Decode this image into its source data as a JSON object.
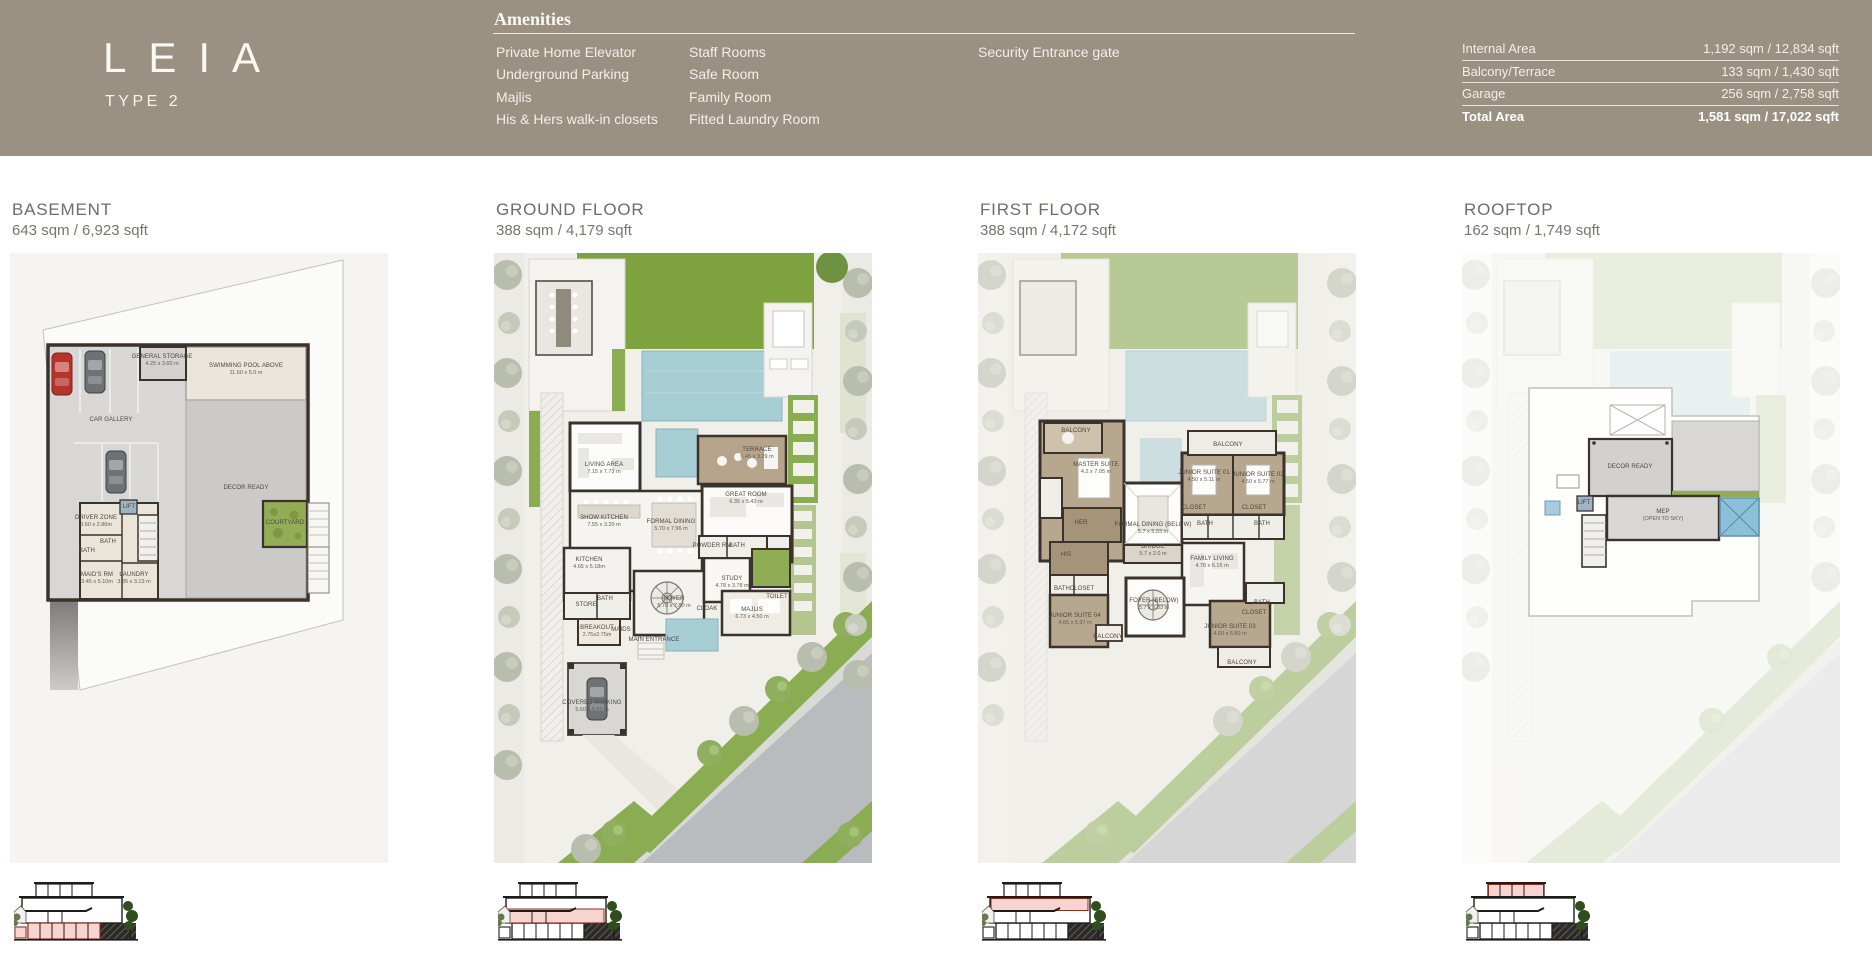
{
  "brand": {
    "logo": "LEIA",
    "subtitle": "TYPE 2"
  },
  "amenities": {
    "title": "Amenities",
    "columns": [
      [
        "Private Home Elevator",
        "Underground Parking",
        "Majlis",
        "His & Hers walk-in closets"
      ],
      [
        "Staff Rooms",
        "Safe Room",
        "Family Room",
        "Fitted Laundry Room"
      ],
      [
        "Security Entrance gate"
      ]
    ]
  },
  "areas": {
    "rows": [
      {
        "label": "Internal Area",
        "value": "1,192 sqm / 12,834 sqft",
        "bold": false
      },
      {
        "label": "Balcony/Terrace",
        "value": "133 sqm / 1,430 sqft",
        "bold": false
      },
      {
        "label": "Garage",
        "value": "256 sqm / 2,758 sqft",
        "bold": false
      },
      {
        "label": "Total Area",
        "value": "1,581 sqm / 17,022 sqft",
        "bold": true
      }
    ]
  },
  "colors": {
    "header_bg": "#9a9183",
    "header_text": "#f6f3eb",
    "floor_title": "#6e6d66",
    "highlight_pink": "#f6c9c6",
    "pool_blue": "#a7cdd5",
    "lawn_green": "#7da23e",
    "wall_dark": "#3a322b",
    "courtyard_green": "#8fad55",
    "road_gray": "#b9bcbf"
  },
  "floors": [
    {
      "id": "basement",
      "title": "BASEMENT",
      "area": "643 sqm / 6,923 sqft",
      "highlight": "basement",
      "rooms": [
        {
          "t": "GENERAL STORAGE",
          "s": "4.25 x 3.60 m",
          "x": 152,
          "y": 107
        },
        {
          "t": "SWIMMING POOL ABOVE",
          "s": "11.60 x 5.0 m",
          "x": 236,
          "y": 116
        },
        {
          "t": "CAR GALLERY",
          "x": 101,
          "y": 167
        },
        {
          "t": "DECOR READY",
          "x": 236,
          "y": 235
        },
        {
          "t": "LIFT",
          "x": 119,
          "y": 254
        },
        {
          "t": "DRIVER ZONE",
          "s": "3.60 x 2.86m",
          "x": 86,
          "y": 268
        },
        {
          "t": "BATH",
          "x": 98,
          "y": 289
        },
        {
          "t": "BATH",
          "x": 77,
          "y": 298
        },
        {
          "t": "MAID'S RM",
          "s": "3.45 x 5.10m",
          "x": 87,
          "y": 325
        },
        {
          "t": "LAUNDRY",
          "s": "3.85 x 3.13 m",
          "x": 124,
          "y": 325
        },
        {
          "t": "COURTYARD",
          "x": 275,
          "y": 270
        }
      ]
    },
    {
      "id": "ground",
      "title": "GROUND FLOOR",
      "area": "388 sqm / 4,179 sqft",
      "highlight": "ground",
      "rooms": [
        {
          "t": "LIVING AREA",
          "s": "7.15 x 7.73 m",
          "x": 110,
          "y": 215
        },
        {
          "t": "TERRACE",
          "s": "6.45 x 3.29 m",
          "x": 263,
          "y": 200
        },
        {
          "t": "GREAT ROOM",
          "s": "6.35 x 5.43 m",
          "x": 252,
          "y": 245
        },
        {
          "t": "SHOW KITCHEN",
          "s": "7.55 x 3.20 m",
          "x": 110,
          "y": 268
        },
        {
          "t": "FORMAL DINING",
          "s": "5.70 x 7.96 m",
          "x": 177,
          "y": 272
        },
        {
          "t": "POWDER RM",
          "x": 218,
          "y": 293
        },
        {
          "t": "BATH",
          "x": 243,
          "y": 293
        },
        {
          "t": "KITCHEN",
          "s": "4.65 x 5.18m",
          "x": 95,
          "y": 310
        },
        {
          "t": "STUDY",
          "s": "4.78 x 3.78 m",
          "x": 238,
          "y": 329
        },
        {
          "t": "BATH",
          "x": 111,
          "y": 346
        },
        {
          "t": "STORE",
          "x": 92,
          "y": 352
        },
        {
          "t": "FOYER",
          "s": "5.78 x 7.80 m",
          "x": 180,
          "y": 349
        },
        {
          "t": "CLOAK",
          "x": 213,
          "y": 356
        },
        {
          "t": "TOILET",
          "x": 283,
          "y": 344
        },
        {
          "t": "MAJLIS",
          "s": "6.73 x 4.50 m",
          "x": 258,
          "y": 360
        },
        {
          "t": "BREAKOUT",
          "s": "2.75x2.75m",
          "x": 103,
          "y": 378
        },
        {
          "t": "MAIDS",
          "x": 127,
          "y": 377
        },
        {
          "t": "MAIN ENTRANCE",
          "x": 160,
          "y": 387
        },
        {
          "t": "COVERED PARKING",
          "s": "5.60 x 5.50 m",
          "x": 98,
          "y": 453
        }
      ]
    },
    {
      "id": "first",
      "title": "FIRST FLOOR",
      "area": "388 sqm / 4,172 sqft",
      "highlight": "first",
      "rooms": [
        {
          "t": "BALCONY",
          "x": 98,
          "y": 178
        },
        {
          "t": "BALCONY",
          "x": 250,
          "y": 192
        },
        {
          "t": "MASTER SUITE",
          "s": "4.2 x 7.05 m",
          "x": 118,
          "y": 215
        },
        {
          "t": "JUNIOR SUITE 01",
          "s": "4.50 x 5.11 m",
          "x": 226,
          "y": 223
        },
        {
          "t": "JUNIOR SUITE 02",
          "s": "4.50 x 5.77 m",
          "x": 280,
          "y": 225
        },
        {
          "t": "CLOSET",
          "x": 216,
          "y": 255
        },
        {
          "t": "CLOSET",
          "x": 276,
          "y": 255
        },
        {
          "t": "HER",
          "x": 103,
          "y": 270
        },
        {
          "t": "BATH",
          "x": 227,
          "y": 271
        },
        {
          "t": "BATH",
          "x": 284,
          "y": 271
        },
        {
          "t": "FORMAL DINING (BELOW)",
          "s": "5.7 x 5.93 m",
          "x": 175,
          "y": 275
        },
        {
          "t": "BRIDGE",
          "s": "5.7 x 2.0 m",
          "x": 175,
          "y": 297
        },
        {
          "t": "HIS",
          "x": 88,
          "y": 302
        },
        {
          "t": "FAMILY LIVING",
          "s": "4.78 x 6.15 m",
          "x": 234,
          "y": 309
        },
        {
          "t": "BATH",
          "x": 84,
          "y": 336
        },
        {
          "t": "CLOSET",
          "x": 104,
          "y": 336
        },
        {
          "t": "FOYER (BELOW)",
          "s": "5.7 x 5.83 m",
          "x": 176,
          "y": 351
        },
        {
          "t": "BATH",
          "x": 284,
          "y": 350
        },
        {
          "t": "CLOSET",
          "x": 276,
          "y": 360
        },
        {
          "t": "JUNIOR SUITE 04",
          "s": "4.65 x 5.37 m",
          "x": 97,
          "y": 366
        },
        {
          "t": "JUNIOR SUITE 03",
          "s": "4.60 x 5.80 m",
          "x": 252,
          "y": 377
        },
        {
          "t": "BALCONY",
          "x": 130,
          "y": 384
        },
        {
          "t": "BALCONY",
          "x": 264,
          "y": 410
        }
      ]
    },
    {
      "id": "roof",
      "title": "ROOFTOP",
      "area": "162 sqm / 1,749 sqft",
      "highlight": "roof",
      "rooms": [
        {
          "t": "DECOR READY",
          "x": 168,
          "y": 214
        },
        {
          "t": "LIFT",
          "x": 122,
          "y": 250
        },
        {
          "t": "MEP",
          "s": "(OPEN TO SKY)",
          "x": 201,
          "y": 262
        }
      ]
    }
  ]
}
